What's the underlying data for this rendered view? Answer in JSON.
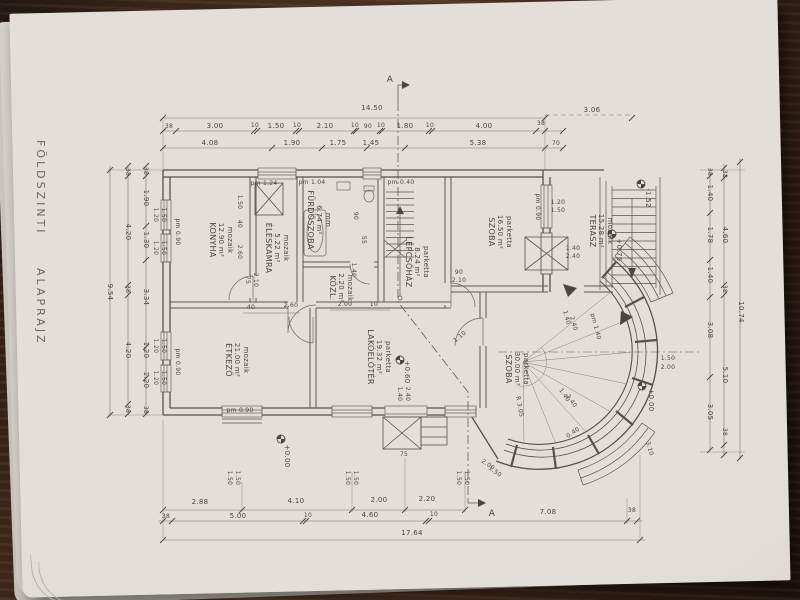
{
  "drawing": {
    "title": "FÖLDSZINTI  ALAPRAJZ",
    "section_letter": "A",
    "colors": {
      "paper": "#e3dfd8",
      "ink": "#4a453e",
      "wood": "#4a3022"
    },
    "rooms": [
      {
        "id": "konyha",
        "name": "KONYHA",
        "area": "12.90 m²",
        "floor": "mozaik",
        "x": 210,
        "y": 240
      },
      {
        "id": "eleskamra",
        "name": "ÉLÉSKAMRA",
        "area": "5.22 m²",
        "floor": "mozaik",
        "x": 266,
        "y": 248
      },
      {
        "id": "furdoszoba",
        "name": "FÜRDŐSZOBA",
        "area": "6.74 m²",
        "floor": "mm",
        "x": 308,
        "y": 220
      },
      {
        "id": "kozlekedo",
        "name": "KÖZL.",
        "area": "2.20 m²",
        "floor": "mozaik",
        "x": 330,
        "y": 288
      },
      {
        "id": "lepcsohaz",
        "name": "LÉPCSŐHÁZ",
        "area": "8.24 m²",
        "floor": "parketta",
        "x": 406,
        "y": 262
      },
      {
        "id": "szoba-1",
        "name": "SZOBA",
        "area": "16.50 m²",
        "floor": "parketta",
        "x": 489,
        "y": 232
      },
      {
        "id": "terasz",
        "name": "TERASZ",
        "area": "15.28 m²",
        "floor": "mozaik",
        "x": 590,
        "y": 231
      },
      {
        "id": "etkezo",
        "name": "ÉTKEZŐ",
        "area": "21.00 m²",
        "floor": "mozaik",
        "x": 226,
        "y": 360
      },
      {
        "id": "lakoeloter",
        "name": "LAKÓELŐTÉR",
        "area": "19.32 m²",
        "floor": "parketta",
        "x": 368,
        "y": 357
      },
      {
        "id": "szoba-2",
        "name": "SZOBA",
        "area": "30.00 m²",
        "floor": "parketta",
        "x": 506,
        "y": 369
      }
    ],
    "annotations": {
      "dims_top": [
        {
          "t": "14.50",
          "x": 372,
          "y": 110
        },
        {
          "t": "38",
          "x": 169,
          "y": 128,
          "s": 6
        },
        {
          "t": "3.00",
          "x": 215,
          "y": 128
        },
        {
          "t": "10",
          "x": 255,
          "y": 127,
          "s": 6
        },
        {
          "t": "1.50",
          "x": 276,
          "y": 128
        },
        {
          "t": "10",
          "x": 297,
          "y": 127,
          "s": 6
        },
        {
          "t": "2.10",
          "x": 325,
          "y": 128
        },
        {
          "t": "10",
          "x": 355,
          "y": 127,
          "s": 6
        },
        {
          "t": "90",
          "x": 368,
          "y": 128,
          "s": 6
        },
        {
          "t": "10",
          "x": 381,
          "y": 127,
          "s": 6
        },
        {
          "t": "1.80",
          "x": 405,
          "y": 128
        },
        {
          "t": "10",
          "x": 430,
          "y": 127,
          "s": 6
        },
        {
          "t": "4.00",
          "x": 484,
          "y": 128
        },
        {
          "t": "38",
          "x": 541,
          "y": 125,
          "s": 6
        },
        {
          "t": "4.08",
          "x": 210,
          "y": 145
        },
        {
          "t": "1.90",
          "x": 292,
          "y": 145
        },
        {
          "t": "1.75",
          "x": 338,
          "y": 145
        },
        {
          "t": "1.45",
          "x": 371,
          "y": 145
        },
        {
          "t": "5.38",
          "x": 478,
          "y": 145
        },
        {
          "t": "70",
          "x": 556,
          "y": 145,
          "s": 6
        },
        {
          "t": "3.06",
          "x": 592,
          "y": 112
        }
      ],
      "dims_bottom": [
        {
          "t": "2.88",
          "x": 200,
          "y": 504
        },
        {
          "t": "4.10",
          "x": 296,
          "y": 503
        },
        {
          "t": "2.00",
          "x": 379,
          "y": 502
        },
        {
          "t": "2.20",
          "x": 427,
          "y": 501
        },
        {
          "t": "38",
          "x": 166,
          "y": 518,
          "s": 6
        },
        {
          "t": "5.00",
          "x": 238,
          "y": 518
        },
        {
          "t": "10",
          "x": 308,
          "y": 517,
          "s": 6
        },
        {
          "t": "4.60",
          "x": 370,
          "y": 517
        },
        {
          "t": "10",
          "x": 434,
          "y": 516,
          "s": 6
        },
        {
          "t": "7.08",
          "x": 548,
          "y": 514
        },
        {
          "t": "38",
          "x": 632,
          "y": 512,
          "s": 6
        },
        {
          "t": "17.64",
          "x": 412,
          "y": 535
        }
      ],
      "dims_left": [
        {
          "t": "9.54",
          "x": 108,
          "y": 292,
          "r": 90
        },
        {
          "t": "38",
          "x": 126,
          "y": 172,
          "r": 90,
          "s": 6
        },
        {
          "t": "4.20",
          "x": 126,
          "y": 232,
          "r": 90
        },
        {
          "t": "38",
          "x": 126,
          "y": 289,
          "r": 90,
          "s": 6
        },
        {
          "t": "4.20",
          "x": 126,
          "y": 350,
          "r": 90
        },
        {
          "t": "38",
          "x": 126,
          "y": 409,
          "r": 90,
          "s": 6
        },
        {
          "t": "38",
          "x": 144,
          "y": 171,
          "r": 90,
          "s": 6
        },
        {
          "t": "1.90",
          "x": 144,
          "y": 198,
          "r": 90
        },
        {
          "t": "1.30",
          "x": 144,
          "y": 240,
          "r": 90
        },
        {
          "t": "3.34",
          "x": 144,
          "y": 297,
          "r": 90
        },
        {
          "t": "1.20",
          "x": 144,
          "y": 350,
          "r": 90
        },
        {
          "t": "1.20",
          "x": 144,
          "y": 380,
          "r": 90
        },
        {
          "t": "38",
          "x": 144,
          "y": 410,
          "r": 90,
          "s": 6
        }
      ],
      "dims_right": [
        {
          "t": "38",
          "x": 708,
          "y": 172,
          "r": 90,
          "s": 6
        },
        {
          "t": "1.40",
          "x": 708,
          "y": 193,
          "r": 90
        },
        {
          "t": "1.78",
          "x": 708,
          "y": 235,
          "r": 90
        },
        {
          "t": "1.40",
          "x": 708,
          "y": 275,
          "r": 90
        },
        {
          "t": "3.08",
          "x": 708,
          "y": 330,
          "r": 90
        },
        {
          "t": "3.05",
          "x": 708,
          "y": 412,
          "r": 90
        },
        {
          "t": "38",
          "x": 723,
          "y": 174,
          "r": 90,
          "s": 6
        },
        {
          "t": "4.60",
          "x": 723,
          "y": 235,
          "r": 90
        },
        {
          "t": "38",
          "x": 723,
          "y": 289,
          "r": 90,
          "s": 6
        },
        {
          "t": "5.10",
          "x": 723,
          "y": 375,
          "r": 90
        },
        {
          "t": "38",
          "x": 723,
          "y": 432,
          "r": 90,
          "s": 6
        },
        {
          "t": "10.74",
          "x": 739,
          "y": 312,
          "r": 90
        }
      ],
      "window_labels": [
        {
          "t": "1.20",
          "x": 154,
          "y": 215,
          "r": 90,
          "s": 6
        },
        {
          "t": "1.50",
          "x": 162,
          "y": 215,
          "r": 90,
          "s": 6
        },
        {
          "t": "1.20",
          "x": 154,
          "y": 248,
          "r": 90,
          "s": 6
        },
        {
          "t": "1.50",
          "x": 162,
          "y": 248,
          "r": 90,
          "s": 6
        },
        {
          "t": "1.20",
          "x": 154,
          "y": 346,
          "r": 90,
          "s": 6
        },
        {
          "t": "1.50",
          "x": 162,
          "y": 346,
          "r": 90,
          "s": 6
        },
        {
          "t": "1.20",
          "x": 154,
          "y": 378,
          "r": 90,
          "s": 6
        },
        {
          "t": "1.50",
          "x": 162,
          "y": 378,
          "r": 90,
          "s": 6
        },
        {
          "t": "1.50",
          "x": 228,
          "y": 478,
          "r": 90,
          "s": 6
        },
        {
          "t": "1.50",
          "x": 236,
          "y": 478,
          "r": 90,
          "s": 6
        },
        {
          "t": "1.50",
          "x": 346,
          "y": 478,
          "r": 90,
          "s": 6
        },
        {
          "t": "1.50",
          "x": 354,
          "y": 478,
          "r": 90,
          "s": 6
        },
        {
          "t": "1.50",
          "x": 457,
          "y": 478,
          "r": 90,
          "s": 6
        },
        {
          "t": "1.50",
          "x": 465,
          "y": 478,
          "r": 90,
          "s": 6
        },
        {
          "t": "1.20",
          "x": 558,
          "y": 204,
          "s": 6
        },
        {
          "t": "1.50",
          "x": 558,
          "y": 212,
          "s": 6
        },
        {
          "t": "1.40",
          "x": 573,
          "y": 250,
          "s": 6
        },
        {
          "t": "2.40",
          "x": 573,
          "y": 258,
          "s": 6
        },
        {
          "t": "1.40",
          "x": 565,
          "y": 318,
          "r": 75,
          "s": 6
        },
        {
          "t": "2.40",
          "x": 572,
          "y": 324,
          "r": 75,
          "s": 6
        },
        {
          "t": "1.40",
          "x": 563,
          "y": 396,
          "r": 55,
          "s": 6
        },
        {
          "t": "2.40",
          "x": 570,
          "y": 402,
          "r": 55,
          "s": 6
        },
        {
          "t": "2.00",
          "x": 487,
          "y": 466,
          "r": 35,
          "s": 6
        },
        {
          "t": "1.50",
          "x": 494,
          "y": 473,
          "r": 35,
          "s": 6
        },
        {
          "t": "1.40",
          "x": 398,
          "y": 394,
          "r": 90,
          "s": 6
        },
        {
          "t": "2.40",
          "x": 406,
          "y": 394,
          "r": 90,
          "s": 6
        }
      ],
      "sill_notes": [
        {
          "t": "pm 0.90",
          "x": 176,
          "y": 232,
          "r": 90,
          "s": 6
        },
        {
          "t": "pm 0.90",
          "x": 176,
          "y": 362,
          "r": 90,
          "s": 6
        },
        {
          "t": "pm 1.24",
          "x": 264,
          "y": 185,
          "s": 6
        },
        {
          "t": "pm 1.04",
          "x": 312,
          "y": 184,
          "s": 6
        },
        {
          "t": "pm 0.40",
          "x": 401,
          "y": 184,
          "s": 6
        },
        {
          "t": "pm 0.90",
          "x": 536,
          "y": 207,
          "r": 90,
          "s": 6
        },
        {
          "t": "pm 0.90",
          "x": 240,
          "y": 412,
          "s": 6
        },
        {
          "t": "pm 1.40",
          "x": 594,
          "y": 327,
          "r": 75,
          "s": 6
        }
      ],
      "levels": [
        {
          "t": "+0.75",
          "x": 617,
          "y": 250,
          "r": 90
        },
        {
          "t": "-1.52",
          "x": 646,
          "y": 198,
          "r": 90
        },
        {
          "t": "+0.00",
          "x": 649,
          "y": 400,
          "r": 90
        },
        {
          "t": "+0.60",
          "x": 405,
          "y": 372,
          "r": 90
        },
        {
          "t": "+0.00",
          "x": 285,
          "y": 456,
          "r": 90
        }
      ],
      "interior_dims": [
        {
          "t": "1.50",
          "x": 238,
          "y": 202,
          "r": 90,
          "s": 6
        },
        {
          "t": "40",
          "x": 238,
          "y": 224,
          "r": 90,
          "s": 6
        },
        {
          "t": "2.60",
          "x": 238,
          "y": 252,
          "r": 90,
          "s": 6
        },
        {
          "t": "75",
          "x": 246,
          "y": 280,
          "r": 90,
          "s": 6
        },
        {
          "t": "2.10",
          "x": 254,
          "y": 280,
          "r": 90,
          "s": 6
        },
        {
          "t": "1.40",
          "x": 352,
          "y": 270,
          "r": 90,
          "s": 6
        },
        {
          "t": "90",
          "x": 354,
          "y": 216,
          "r": 90,
          "s": 6
        },
        {
          "t": "55",
          "x": 362,
          "y": 240,
          "r": 90,
          "s": 6
        },
        {
          "t": "90",
          "x": 459,
          "y": 274,
          "s": 6
        },
        {
          "t": "2.10",
          "x": 459,
          "y": 282,
          "s": 6
        },
        {
          "t": "40",
          "x": 251,
          "y": 309,
          "s": 6
        },
        {
          "t": "2.60",
          "x": 291,
          "y": 307,
          "s": 6
        },
        {
          "t": "2.00",
          "x": 345,
          "y": 306,
          "s": 6
        },
        {
          "t": "10",
          "x": 374,
          "y": 306,
          "s": 6
        },
        {
          "t": "1.10",
          "x": 461,
          "y": 338,
          "r": -40,
          "s": 6
        },
        {
          "t": "75",
          "x": 404,
          "y": 456,
          "s": 6
        },
        {
          "t": "1.50",
          "x": 668,
          "y": 360,
          "s": 6
        },
        {
          "t": "2.00",
          "x": 668,
          "y": 369,
          "s": 6
        },
        {
          "t": "3.10",
          "x": 648,
          "y": 449,
          "r": 75,
          "s": 6
        },
        {
          "t": "R 3.05",
          "x": 518,
          "y": 407,
          "r": 80,
          "s": 6
        },
        {
          "t": "0.40",
          "x": 574,
          "y": 434,
          "r": -35,
          "s": 6
        }
      ],
      "section_marks": [
        {
          "t": "A",
          "x": 390,
          "y": 82,
          "s": 9
        },
        {
          "t": "A",
          "x": 492,
          "y": 516,
          "s": 9
        }
      ]
    }
  }
}
